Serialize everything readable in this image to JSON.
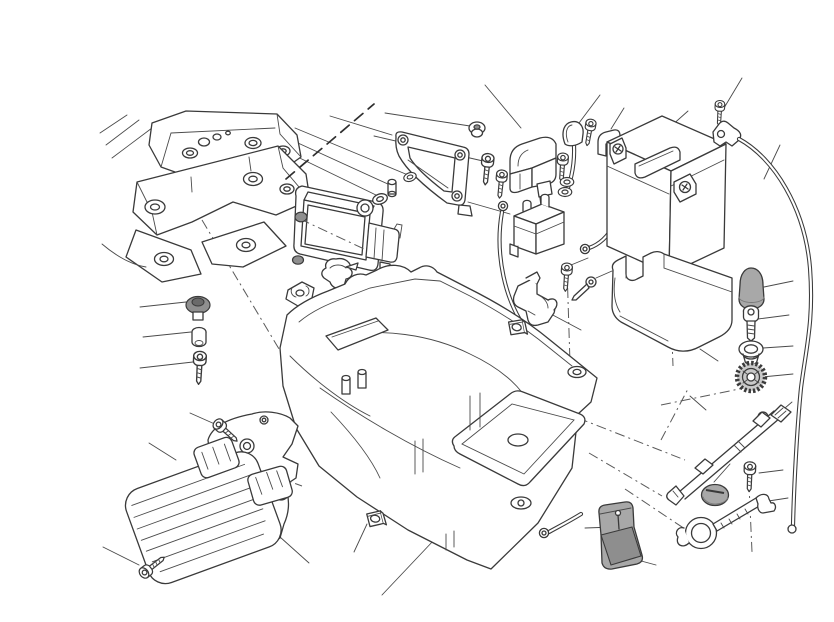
{
  "diagram": {
    "kind": "exploded-parts-technical-illustration",
    "subject": "motorcycle battery holder, battery tray and electrical components",
    "canvas": {
      "width": 834,
      "height": 590
    },
    "colors": {
      "background": "#ffffff",
      "line": "#3a3a3a",
      "rubber_gray": "#a8a8a8",
      "dark_gray": "#8f8f8f",
      "knurl_gray": "#c9c9c9"
    }
  },
  "parts": [
    {
      "id": "rear-subframe",
      "label": "Rear subframe"
    },
    {
      "id": "section-cut-line",
      "label": "Section cut line"
    },
    {
      "id": "ecu-mounting-bracket",
      "label": "ECU mounting bracket"
    },
    {
      "id": "bracket-grommet",
      "label": "Rubber grommet"
    },
    {
      "id": "bracket-screw",
      "label": "Bracket screw"
    },
    {
      "id": "engine-control-unit",
      "label": "Engine control unit"
    },
    {
      "id": "ecu-grommets",
      "label": "ECU rubber grommets"
    },
    {
      "id": "ecu-spacer-stack",
      "label": "Washers and spacer"
    },
    {
      "id": "rubber-damper-mount",
      "label": "Rubber damper mount"
    },
    {
      "id": "spring-clip",
      "label": "Spring clip"
    },
    {
      "id": "solenoid-cover",
      "label": "Starter solenoid cover"
    },
    {
      "id": "starter-solenoid",
      "label": "Starter solenoid"
    },
    {
      "id": "terminal-boot",
      "label": "Terminal rubber boot"
    },
    {
      "id": "cable-guide",
      "label": "Cable guide bracket"
    },
    {
      "id": "terminal-hardware",
      "label": "Terminal screw and washers"
    },
    {
      "id": "ground-cable",
      "label": "Ground cable with ring terminal"
    },
    {
      "id": "battery",
      "label": "Battery"
    },
    {
      "id": "battery-terminals",
      "label": "Battery terminal plates"
    },
    {
      "id": "cable-clamp",
      "label": "Cable clamp and screw"
    },
    {
      "id": "negative-cable",
      "label": "Negative battery cable"
    },
    {
      "id": "battery-strap",
      "label": "Battery holder strap"
    },
    {
      "id": "rubber-cap",
      "label": "Rubber cap"
    },
    {
      "id": "strap-bolt",
      "label": "Strap bolt"
    },
    {
      "id": "strap-grommet",
      "label": "Strap washer grommet"
    },
    {
      "id": "knurled-nut",
      "label": "Knurled nut"
    },
    {
      "id": "battery-tray",
      "label": "Battery tray"
    },
    {
      "id": "tray-fasteners",
      "label": "Tray grommet, spacer and screw"
    },
    {
      "id": "tray-clip-nut",
      "label": "Tray clip nut"
    },
    {
      "id": "hook-bracket",
      "label": "Hook bracket with screw and pin"
    },
    {
      "id": "hook-clip-nut",
      "label": "Hook clip nut"
    },
    {
      "id": "voltage-regulator",
      "label": "Voltage regulator"
    },
    {
      "id": "regulator-bracket",
      "label": "Regulator mounting bracket"
    },
    {
      "id": "regulator-screws",
      "label": "Regulator screws"
    },
    {
      "id": "seat-lock-rod",
      "label": "Seat lock rod"
    },
    {
      "id": "seat-lock-cap",
      "label": "Seat lock cap"
    },
    {
      "id": "seat-lock-screw",
      "label": "Seat lock screw"
    },
    {
      "id": "seat-lock-lever",
      "label": "Seat lock lever"
    },
    {
      "id": "corner-cover",
      "label": "Rubber corner cover"
    },
    {
      "id": "leader-lines",
      "label": "Callout leader lines"
    },
    {
      "id": "construction-lines",
      "label": "Assembly axis lines"
    }
  ]
}
